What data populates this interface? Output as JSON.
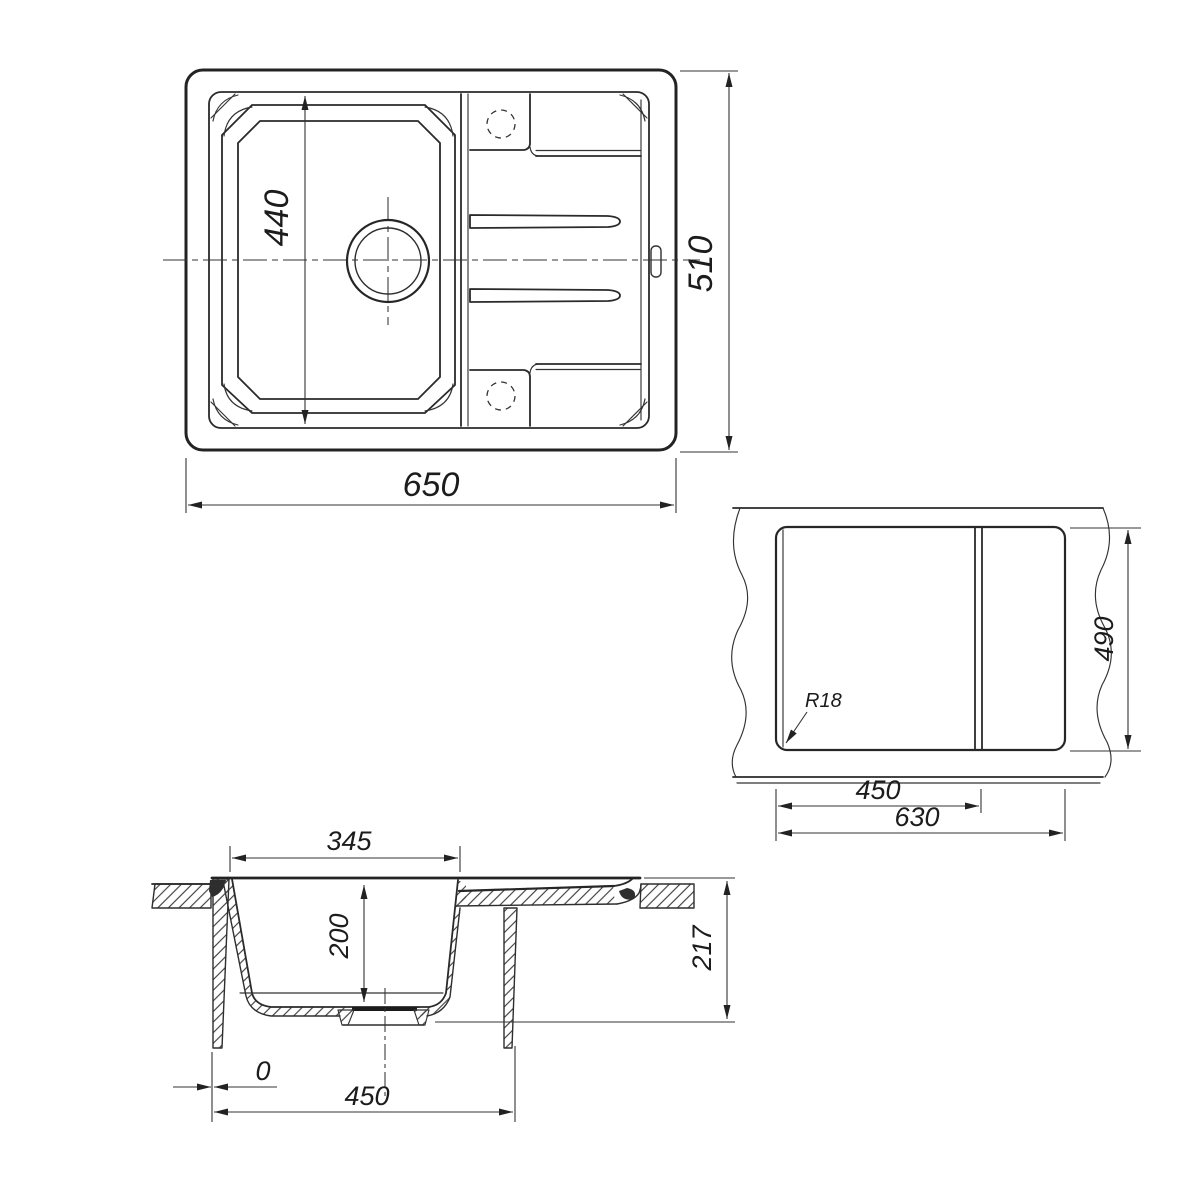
{
  "page": {
    "background": "#ffffff",
    "ink": "#262626"
  },
  "views": {
    "top": {
      "label": "sink-top-view",
      "dims": {
        "basin_height": "440",
        "overall_height": "510",
        "overall_width": "650"
      }
    },
    "cutout": {
      "label": "countertop-cutout-view",
      "dims": {
        "corner_radius": "R18",
        "cutout_height": "490",
        "bowl_section_width": "450",
        "cutout_width": "630"
      }
    },
    "section": {
      "label": "cross-section-view",
      "dims": {
        "bowl_top_width": "345",
        "bowl_depth": "200",
        "overall_depth": "217",
        "edge_offset": "0",
        "bowl_outer_width": "450"
      }
    }
  }
}
